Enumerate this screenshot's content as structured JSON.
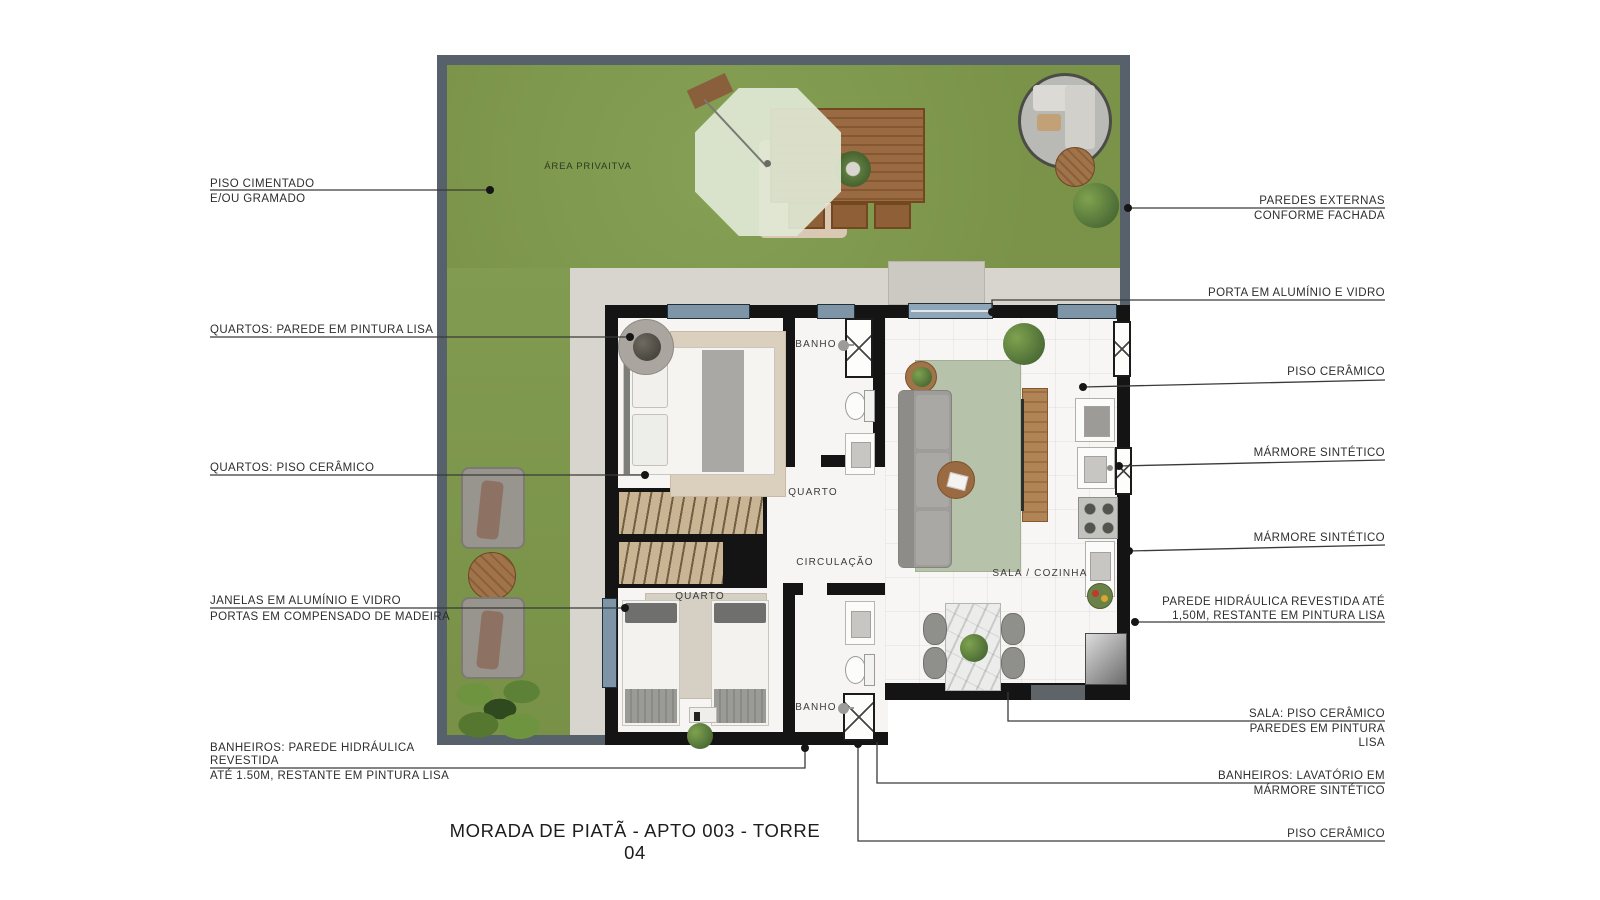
{
  "title": "MORADA DE PIATÃ - APTO 003 - TORRE 04",
  "plan": {
    "area_label": "ÁREA PRIVAITVA",
    "rooms": {
      "banho1": "BANHO",
      "quarto1": "QUARTO",
      "circulacao": "CIRCULAÇÃO",
      "quarto2": "QUARTO",
      "banho2": "BANHO",
      "sala": "SALA / COZINHA"
    }
  },
  "annotations": {
    "left": [
      {
        "l1": "PISO CIMENTADO",
        "l2": "E/OU GRAMADO"
      },
      {
        "l1": "QUARTOS: PAREDE EM PINTURA LISA"
      },
      {
        "l1": "QUARTOS: PISO CERÂMICO"
      },
      {
        "l1": "JANELAS EM ALUMÍNIO E VIDRO",
        "l2": "PORTAS EM COMPENSADO DE MADEIRA"
      },
      {
        "l1": "BANHEIROS: PAREDE HIDRÁULICA",
        "l2": "REVESTIDA",
        "l3": "ATÉ 1.50M, RESTANTE EM PINTURA LISA"
      }
    ],
    "right": [
      {
        "l1": "PAREDES EXTERNAS",
        "l2": "CONFORME FACHADA"
      },
      {
        "l1": "PORTA EM ALUMÍNIO E VIDRO"
      },
      {
        "l1": "PISO CERÂMICO"
      },
      {
        "l1": "MÁRMORE SINTÉTICO"
      },
      {
        "l1": "MÁRMORE SINTÉTICO"
      },
      {
        "l1": "PAREDE HIDRÁULICA REVESTIDA ATÉ",
        "l2": "1,50M, RESTANTE EM PINTURA LISA"
      },
      {
        "l1": "SALA: PISO CERÂMICO",
        "l2": "PAREDES EM PINTURA",
        "l3": "LISA"
      },
      {
        "l1": "BANHEIROS: LAVATÓRIO EM",
        "l2": "MÁRMORE SINTÉTICO"
      },
      {
        "l1": "PISO CERÂMICO"
      }
    ]
  },
  "colors": {
    "grass": "#7F9950",
    "boundary_wall": "#57616B",
    "concrete_path": "#D8D5CE",
    "interior_wall": "#141414",
    "window": "#7E95A8",
    "floor": "#F6F5F3",
    "leader_line": "#3A3A3A"
  }
}
